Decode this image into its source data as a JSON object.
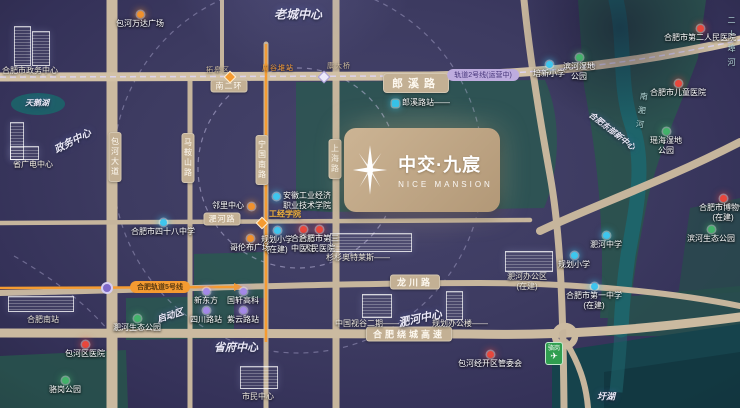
{
  "project": {
    "name_cn": "中交·九宸",
    "name_en": "NICE MANSION"
  },
  "colors": {
    "school": "#3ec6ee",
    "hospital": "#e8473c",
    "park": "#43b36a",
    "commercial": "#f0912d",
    "company": "#a489e8",
    "metro": "#35c3e8",
    "road": "#c6b59c",
    "metro_orange": "#f59b31",
    "badge_bg": "#c3b094"
  },
  "road_badges": [
    {
      "id": "nanerhuan",
      "text": "南二环",
      "x": 229,
      "y": 86,
      "vertical": false,
      "size": "sm"
    },
    {
      "id": "langxilu",
      "text": "郎溪路",
      "x": 416,
      "y": 83,
      "vertical": false,
      "size": "lg"
    },
    {
      "id": "longchuanlu",
      "text": "龙川路",
      "x": 415,
      "y": 282,
      "vertical": false,
      "size": "md"
    },
    {
      "id": "raochenggaosu",
      "text": "合肥绕城高速",
      "x": 409,
      "y": 334,
      "vertical": false,
      "size": "md"
    },
    {
      "id": "feihelu",
      "text": "淝河路",
      "x": 222,
      "y": 219,
      "vertical": false,
      "size": "sm"
    },
    {
      "id": "baohedadao",
      "text": "包河大道",
      "x": 115,
      "y": 157,
      "vertical": true
    },
    {
      "id": "maanshanlu",
      "text": "马鞍山路",
      "x": 188,
      "y": 158,
      "vertical": true
    },
    {
      "id": "ningguonanlu",
      "text": "宁国南路",
      "x": 262,
      "y": 160,
      "vertical": true
    },
    {
      "id": "shanghailu",
      "text": "上海路",
      "x": 335,
      "y": 159,
      "vertical": true
    }
  ],
  "road_texts": [
    {
      "id": "tuogaoqu",
      "text": "拓皋区",
      "x": 218,
      "y": 70,
      "color": "#cdbb9f"
    },
    {
      "id": "kangdaqiao",
      "text": "康大桥",
      "x": 339,
      "y": 66,
      "color": "#cdbb9f"
    },
    {
      "id": "zhouguduizhan",
      "text": "周谷堆站",
      "x": 278,
      "y": 68,
      "color": "#f59b31"
    }
  ],
  "transit_pills": [
    {
      "id": "line2",
      "text": "轨道2号线(运营中)",
      "x": 483,
      "y": 75,
      "style": "purple"
    },
    {
      "id": "line5",
      "text": "合肥轨道5号线",
      "x": 160,
      "y": 287,
      "style": "orange"
    }
  ],
  "district_labels": [
    {
      "id": "laochengzhongxin",
      "text": "老城中心",
      "x": 298,
      "y": 14,
      "size": 12,
      "rot": 0
    },
    {
      "id": "zhengwuzhongxin",
      "text": "政务中心",
      "x": 72,
      "y": 140,
      "size": 10,
      "rot": -28
    },
    {
      "id": "tianehu",
      "text": "天鹅湖",
      "x": 37,
      "y": 103,
      "size": 8,
      "rot": 0
    },
    {
      "id": "feihezhongxin",
      "text": "淝河中心",
      "x": 420,
      "y": 318,
      "size": 11,
      "rot": -12
    },
    {
      "id": "shengfuzhongxin",
      "text": "省府中心",
      "x": 236,
      "y": 347,
      "size": 11,
      "rot": 0
    },
    {
      "id": "qidongqu",
      "text": "启动区",
      "x": 170,
      "y": 315,
      "size": 9,
      "rot": -18
    },
    {
      "id": "dongbuxinzhongxin",
      "text": "合肥东部新中心",
      "x": 612,
      "y": 131,
      "size": 8,
      "rot": 38
    },
    {
      "id": "gongjingxueyuan",
      "text": "工经学院",
      "x": 285,
      "y": 214,
      "size": 8,
      "rot": 0,
      "color": "#f5b53c"
    },
    {
      "id": "yuhu",
      "text": "圩湖",
      "x": 606,
      "y": 396,
      "size": 9,
      "rot": 0
    }
  ],
  "river_labels": [
    {
      "id": "nanfeihe",
      "text": "南淝河",
      "x": 636,
      "y": 92,
      "rot": 8
    },
    {
      "id": "ershipuhe",
      "text": "二十埠河",
      "x": 726,
      "y": 16,
      "rot": 0
    }
  ],
  "pois": [
    {
      "id": "wandaguangchang",
      "type": "commercial",
      "x": 140,
      "y": 14,
      "label": [
        "包河万达广场"
      ]
    },
    {
      "id": "sishibazhong",
      "type": "school",
      "x": 163,
      "y": 222,
      "label": [
        "合肥市四十八中学"
      ]
    },
    {
      "id": "guihuaxiaoxue-1",
      "type": "school",
      "x": 277,
      "y": 230,
      "label": [
        "规划小学",
        "(在建)"
      ]
    },
    {
      "id": "zhongyiyuan",
      "type": "hospital",
      "x": 303,
      "y": 229,
      "label": [
        "合肥市",
        "中医院"
      ]
    },
    {
      "id": "disanrenminyiyuan",
      "type": "hospital",
      "x": 319,
      "y": 229,
      "label": [
        "合肥市第三",
        "人民医院"
      ]
    },
    {
      "id": "gongyejingjixueyuan",
      "type": "school",
      "x": 276,
      "y": 196,
      "label": [
        "安徽工业经济",
        "职业技术学院"
      ],
      "lp": "right"
    },
    {
      "id": "linlizhongxin",
      "type": "commercial",
      "x": 251,
      "y": 206,
      "label": [
        "邻里中心"
      ],
      "lp": "left"
    },
    {
      "id": "gelunbuguangchang",
      "type": "commercial",
      "x": 250,
      "y": 238,
      "label": [
        "哥伦布广场"
      ]
    },
    {
      "id": "peixinxiaoxue",
      "type": "school",
      "x": 549,
      "y": 64,
      "label": [
        "培新小学"
      ]
    },
    {
      "id": "binheshidigongyuan",
      "type": "park",
      "x": 579,
      "y": 57,
      "label": [
        "滨河湿地",
        "公园"
      ]
    },
    {
      "id": "dierrenminyiyuan",
      "type": "hospital",
      "x": 700,
      "y": 28,
      "label": [
        "合肥市第二人民医院"
      ]
    },
    {
      "id": "ertongyiyuan",
      "type": "hospital",
      "x": 678,
      "y": 83,
      "label": [
        "合肥市儿童医院"
      ]
    },
    {
      "id": "yaohaishidigongyuan",
      "type": "park",
      "x": 666,
      "y": 131,
      "label": [
        "瑶海湿地",
        "公园"
      ]
    },
    {
      "id": "bowuguan",
      "type": "hospital",
      "x": 723,
      "y": 198,
      "label": [
        "合肥市博物馆",
        "(在建)"
      ]
    },
    {
      "id": "binheshengtaigongyuan",
      "type": "park",
      "x": 711,
      "y": 229,
      "label": [
        "滨河生态公园"
      ]
    },
    {
      "id": "feihezhongxue",
      "type": "school",
      "x": 606,
      "y": 235,
      "label": [
        "淝河中学"
      ]
    },
    {
      "id": "hefeiyizhong",
      "type": "school",
      "x": 594,
      "y": 286,
      "label": [
        "合肥市第一中学",
        "(在建)"
      ]
    },
    {
      "id": "guihuaxiaoxue-2",
      "type": "school",
      "x": 574,
      "y": 255,
      "label": [
        "规划小学"
      ]
    },
    {
      "id": "jingkaiquguanweihui",
      "type": "hospital",
      "x": 490,
      "y": 354,
      "label": [
        "包河经开区管委会"
      ]
    },
    {
      "id": "xindongfang",
      "type": "company",
      "x": 206,
      "y": 291,
      "label": [
        "新东方"
      ]
    },
    {
      "id": "guoxuangaoke",
      "type": "company",
      "x": 243,
      "y": 291,
      "label": [
        "国轩高科"
      ]
    },
    {
      "id": "sichuanluzhan",
      "type": "company",
      "x": 206,
      "y": 310,
      "label": [
        "四川路站"
      ]
    },
    {
      "id": "ziyunluzhan",
      "type": "company",
      "x": 243,
      "y": 310,
      "label": [
        "紫云路站"
      ]
    },
    {
      "id": "feiheshengtaigongyuan",
      "type": "park",
      "x": 137,
      "y": 318,
      "label": [
        "淝河生态公园"
      ]
    },
    {
      "id": "baohequyiyuan",
      "type": "hospital",
      "x": 85,
      "y": 344,
      "label": [
        "包河区医院"
      ]
    },
    {
      "id": "luoganggongyuan",
      "type": "park",
      "x": 65,
      "y": 380,
      "label": [
        "骆岗公园"
      ]
    },
    {
      "id": "langxiluzhan",
      "type": "metro",
      "x": 395,
      "y": 103,
      "label": [
        "郎溪路站——"
      ],
      "lp": "right"
    }
  ],
  "building_labels": [
    {
      "id": "zhengwubuilding",
      "text": [
        "合肥市政务中心"
      ],
      "x": 30,
      "y": 66
    },
    {
      "id": "shengguangdianzhongxin",
      "text": [
        "省广电中心"
      ],
      "x": 33,
      "y": 160
    },
    {
      "id": "hefeinanzhan",
      "text": [
        "合肥南站"
      ],
      "x": 43,
      "y": 315
    },
    {
      "id": "shanshanaotelaisi",
      "text": [
        "杉杉奥特莱斯——"
      ],
      "x": 358,
      "y": 253
    },
    {
      "id": "zhongguoshigu",
      "text": [
        "中国视谷二期——"
      ],
      "x": 367,
      "y": 319
    },
    {
      "id": "guihuabangonglou",
      "text": [
        "规划办公楼——"
      ],
      "x": 460,
      "y": 319
    },
    {
      "id": "feihebangongqu",
      "text": [
        "淝河办公区",
        "(在建)"
      ],
      "x": 527,
      "y": 272
    },
    {
      "id": "shiminzhongxin",
      "text": [
        "市民中心"
      ],
      "x": 258,
      "y": 392
    }
  ],
  "stations": [
    {
      "id": "nanerhuan-interchange",
      "kind": "diamond-orange",
      "x": 230,
      "y": 77
    },
    {
      "id": "shanghailu-crossing",
      "kind": "diamond-white",
      "x": 324,
      "y": 77
    },
    {
      "id": "gongjingxueyuan-station",
      "kind": "diamond-orange",
      "x": 262,
      "y": 223
    },
    {
      "id": "line5-node",
      "kind": "node-purple",
      "x": 107,
      "y": 288
    }
  ],
  "airport_badge": {
    "text": "骆岗",
    "icon": "✈",
    "x": 545,
    "y": 342
  }
}
